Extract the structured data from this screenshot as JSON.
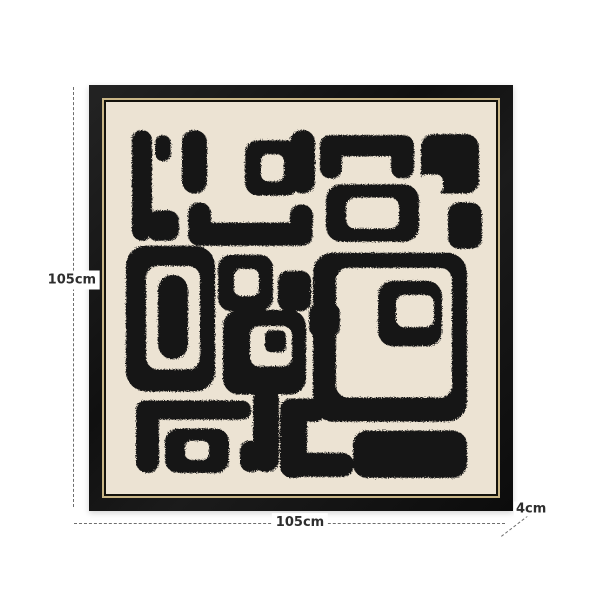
{
  "page": {
    "background": "#ffffff"
  },
  "product": {
    "kind": "framed-abstract-wall-art-dimension-diagram",
    "frame_color": "#141414",
    "gold_trim_color": "#c9b687",
    "inner_trim_color": "#14120c",
    "canvas_color": "#ece3d3",
    "paint_color": "#161616",
    "annotation_line_color": "#6e6e6e",
    "annotation_text_color": "#2e2e2e"
  },
  "dimensions": {
    "height_label": "105cm",
    "width_label": "105cm",
    "depth_label": "4cm"
  },
  "painting": {
    "viewbox": "0 0 390 390",
    "shapes": [
      {
        "t": "rect",
        "x": 26,
        "y": 28,
        "w": 20,
        "h": 110,
        "r": 10
      },
      {
        "t": "rect",
        "x": 41,
        "y": 108,
        "w": 32,
        "h": 30,
        "r": 10
      },
      {
        "t": "rect",
        "x": 49,
        "y": 33,
        "w": 16,
        "h": 26,
        "r": 8
      },
      {
        "t": "rect",
        "x": 76,
        "y": 28,
        "w": 25,
        "h": 63,
        "r": 12
      },
      {
        "t": "rect",
        "x": 184,
        "y": 28,
        "w": 25,
        "h": 63,
        "r": 12
      },
      {
        "t": "rect",
        "x": 82,
        "y": 100,
        "w": 23,
        "h": 32,
        "r": 11
      },
      {
        "t": "rect",
        "x": 82,
        "y": 120,
        "w": 125,
        "h": 23,
        "r": 11
      },
      {
        "t": "rect",
        "x": 184,
        "y": 102,
        "w": 23,
        "h": 30,
        "r": 11
      },
      {
        "t": "ring",
        "x": 139,
        "y": 38,
        "w": 54,
        "h": 55,
        "r": 13,
        "hx": 155,
        "hy": 52,
        "hw": 23,
        "hh": 27,
        "hr": 7
      },
      {
        "t": "rect",
        "x": 214,
        "y": 33,
        "w": 92,
        "h": 21,
        "r": 10
      },
      {
        "t": "rect",
        "x": 214,
        "y": 33,
        "w": 22,
        "h": 43,
        "r": 10
      },
      {
        "t": "rect",
        "x": 285,
        "y": 33,
        "w": 23,
        "h": 43,
        "r": 10
      },
      {
        "t": "ring",
        "x": 220,
        "y": 82,
        "w": 93,
        "h": 57,
        "r": 15,
        "hx": 240,
        "hy": 95,
        "hw": 53,
        "hh": 31,
        "hr": 9
      },
      {
        "t": "rect",
        "x": 315,
        "y": 32,
        "w": 58,
        "h": 59,
        "r": 13
      },
      {
        "t": "cut",
        "x": 314,
        "y": 72,
        "w": 23,
        "h": 20,
        "r": 7
      },
      {
        "t": "rect",
        "x": 342,
        "y": 100,
        "w": 34,
        "h": 46,
        "r": 11
      },
      {
        "t": "ring",
        "x": 20,
        "y": 143,
        "w": 89,
        "h": 145,
        "r": 20,
        "hx": 40,
        "hy": 163,
        "hw": 54,
        "hh": 103,
        "hr": 12
      },
      {
        "t": "rect",
        "x": 52,
        "y": 172,
        "w": 30,
        "h": 84,
        "r": 15
      },
      {
        "t": "ring",
        "x": 112,
        "y": 152,
        "w": 55,
        "h": 56,
        "r": 13,
        "hx": 128,
        "hy": 166,
        "hw": 25,
        "hh": 27,
        "hr": 7
      },
      {
        "t": "rect",
        "x": 172,
        "y": 168,
        "w": 33,
        "h": 40,
        "r": 10
      },
      {
        "t": "rect",
        "x": 203,
        "y": 200,
        "w": 31,
        "h": 34,
        "r": 10
      },
      {
        "t": "ring",
        "x": 117,
        "y": 207,
        "w": 83,
        "h": 84,
        "r": 16,
        "hx": 144,
        "hy": 223,
        "hw": 42,
        "hh": 40,
        "hr": 9
      },
      {
        "t": "rect",
        "x": 159,
        "y": 227,
        "w": 21,
        "h": 22,
        "r": 6
      },
      {
        "t": "ring",
        "x": 207,
        "y": 150,
        "w": 154,
        "h": 168,
        "r": 20,
        "hx": 230,
        "hy": 165,
        "hw": 116,
        "hh": 129,
        "hr": 12
      },
      {
        "t": "ring",
        "x": 272,
        "y": 178,
        "w": 64,
        "h": 65,
        "r": 15,
        "hx": 290,
        "hy": 192,
        "hw": 38,
        "hh": 32,
        "hr": 8
      },
      {
        "t": "rect",
        "x": 30,
        "y": 297,
        "w": 115,
        "h": 19,
        "r": 9
      },
      {
        "t": "rect",
        "x": 30,
        "y": 297,
        "w": 23,
        "h": 72,
        "r": 11
      },
      {
        "t": "ring",
        "x": 59,
        "y": 325,
        "w": 64,
        "h": 44,
        "r": 13,
        "hx": 79,
        "hy": 337,
        "hw": 24,
        "hh": 19,
        "hr": 6
      },
      {
        "t": "rect",
        "x": 147,
        "y": 285,
        "w": 26,
        "h": 83,
        "r": 12
      },
      {
        "t": "rect",
        "x": 134,
        "y": 337,
        "w": 22,
        "h": 31,
        "r": 10
      },
      {
        "t": "rect",
        "x": 174,
        "y": 295,
        "w": 46,
        "h": 23,
        "r": 11
      },
      {
        "t": "rect",
        "x": 174,
        "y": 300,
        "w": 27,
        "h": 74,
        "r": 12
      },
      {
        "t": "rect",
        "x": 174,
        "y": 349,
        "w": 74,
        "h": 24,
        "r": 12
      },
      {
        "t": "rect",
        "x": 247,
        "y": 327,
        "w": 114,
        "h": 47,
        "r": 14
      }
    ]
  }
}
